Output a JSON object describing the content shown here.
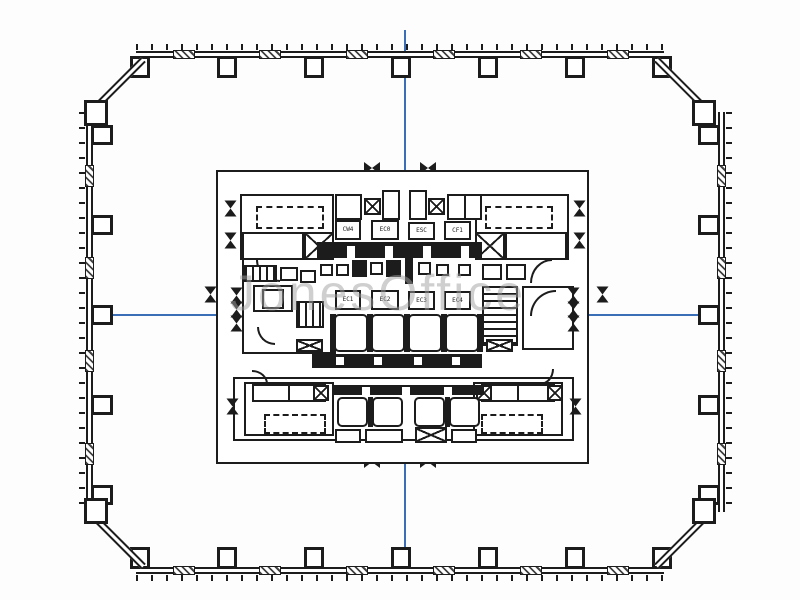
{
  "watermark": {
    "text": "JonesOffice"
  },
  "colors": {
    "ink": "#1c1c1c",
    "blue": "#3a6fb8",
    "wm": "#a0a0a0"
  },
  "core": {
    "shaft_row1": [
      "CW4",
      "EC0",
      "ESC",
      "CF1"
    ],
    "shaft_row2": [
      "EC1",
      "EC2",
      "EC3",
      "EC4"
    ]
  }
}
